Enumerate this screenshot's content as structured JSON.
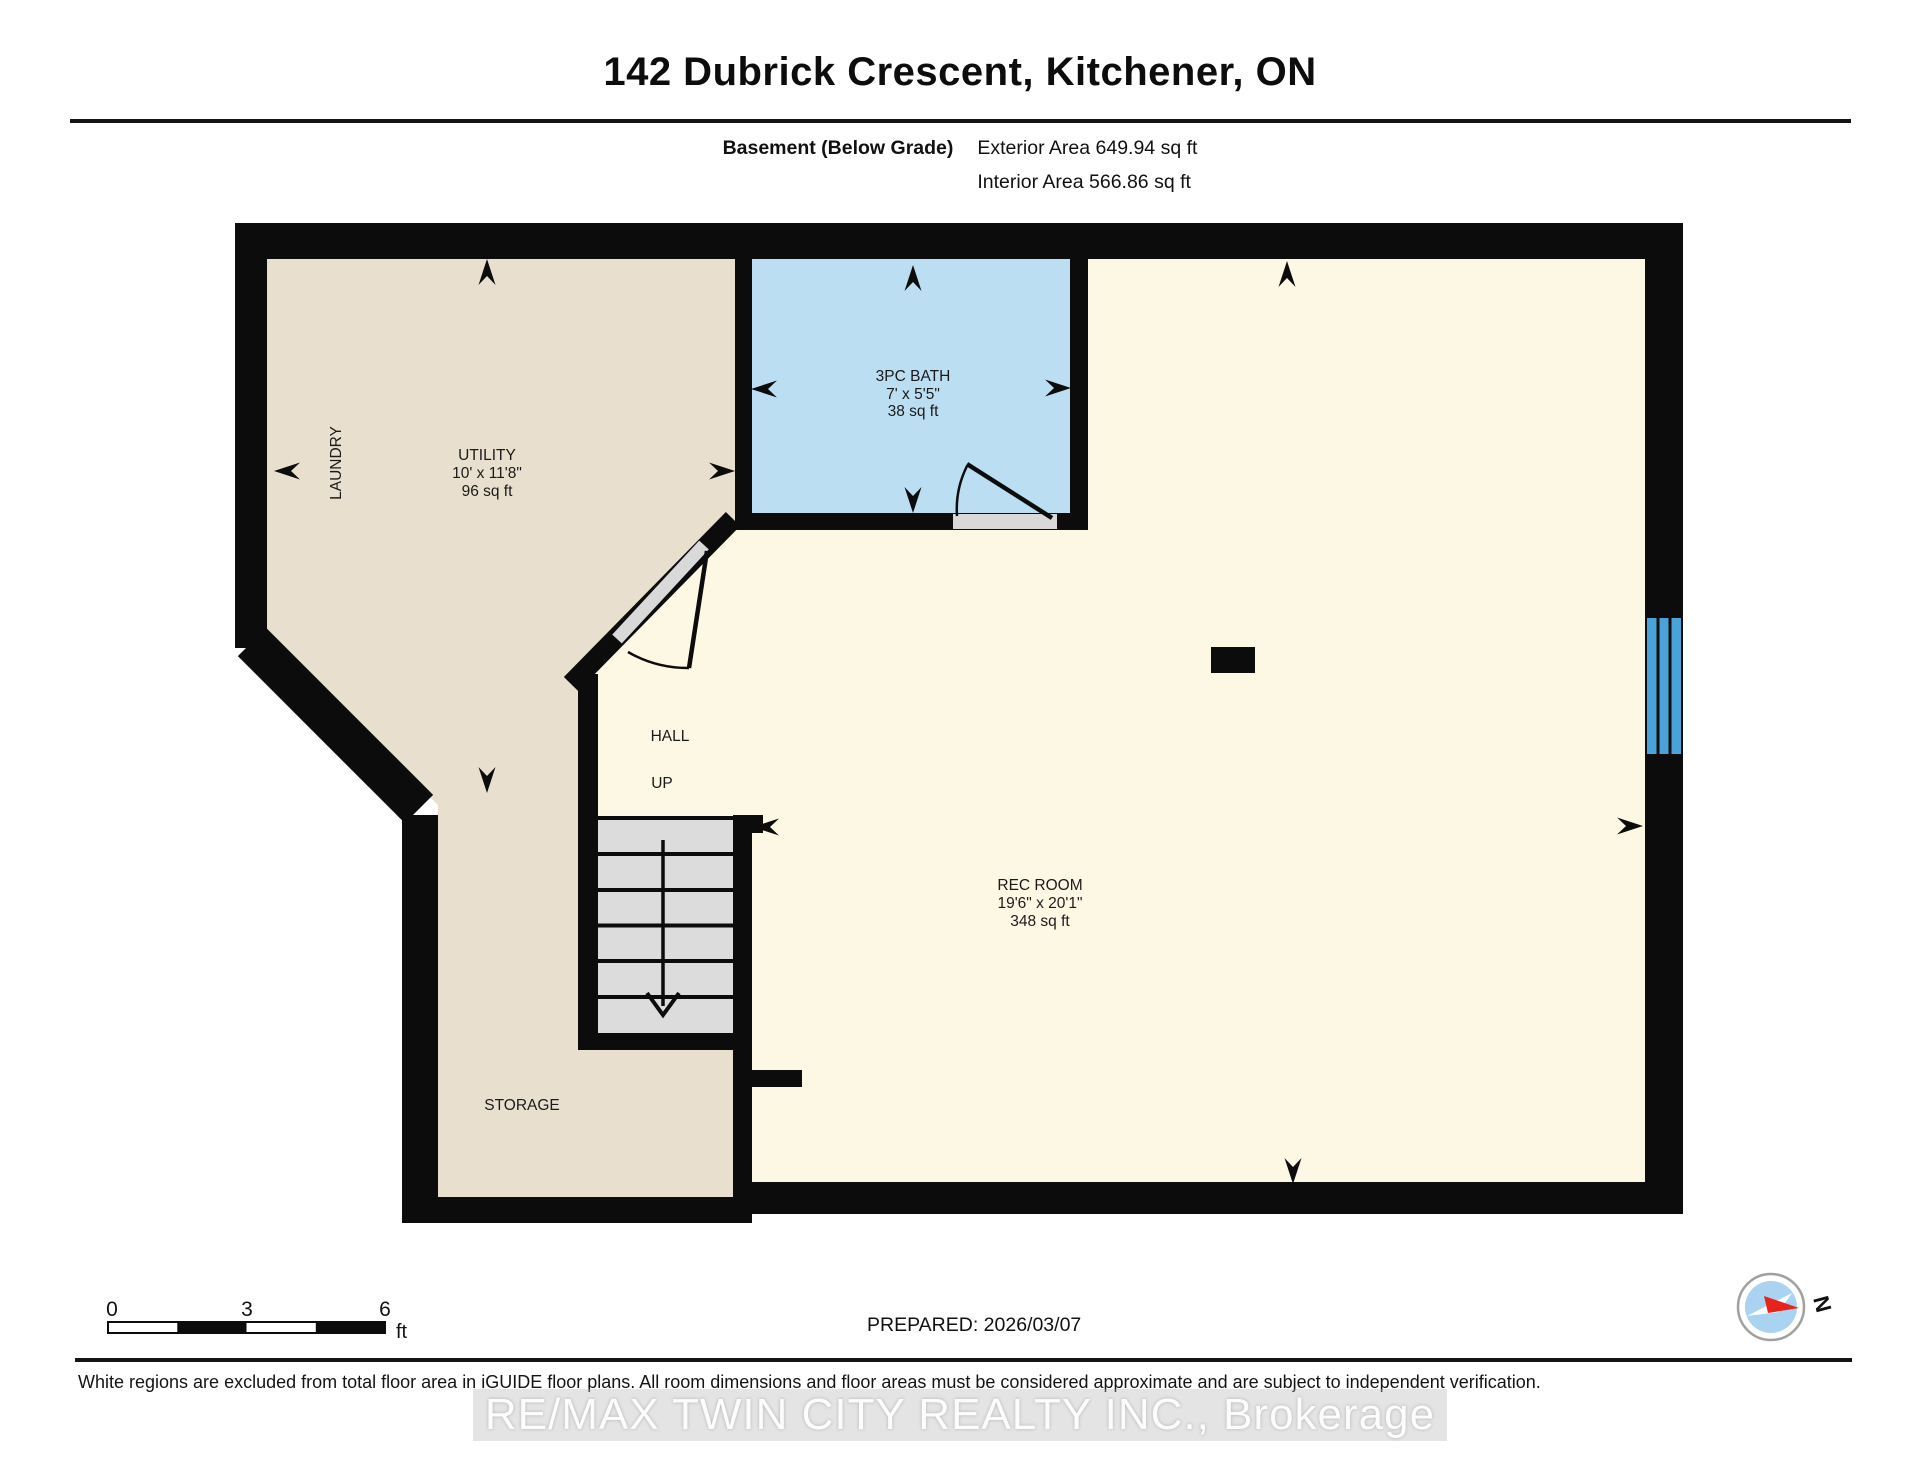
{
  "header": {
    "title": "142 Dubrick Crescent, Kitchener, ON",
    "floor_label": "Basement (Below Grade)",
    "exterior_area": "Exterior Area 649.94 sq ft",
    "interior_area": "Interior Area 566.86 sq ft"
  },
  "rooms": {
    "utility": {
      "name": "UTILITY",
      "dims": "10' x 11'8\"",
      "area": "96 sq ft"
    },
    "laundry": {
      "name": "LAUNDRY"
    },
    "bath": {
      "name": "3PC BATH",
      "dims": "7' x 5'5\"",
      "area": "38 sq ft"
    },
    "hall": {
      "name": "HALL"
    },
    "stairs": {
      "name": "UP"
    },
    "rec": {
      "name": "REC ROOM",
      "dims": "19'6\" x 20'1\"",
      "area": "348 sq ft"
    },
    "storage": {
      "name": "STORAGE"
    }
  },
  "scale_bar": {
    "zero": "0",
    "three": "3",
    "six": "6",
    "unit": "ft"
  },
  "footer": {
    "prepared": "PREPARED: 2026/03/07",
    "compass_label": "N",
    "disclaimer": "White regions are excluded from total floor area in iGUIDE floor plans. All room dimensions and floor areas must be considered approximate and are subject to independent verification.",
    "watermark": "RE/MAX TWIN CITY REALTY INC., Brokerage"
  },
  "colors": {
    "wall": "#0c0c0c",
    "utility_fill": "#e8dfce",
    "rec_fill": "#fdf8e4",
    "bath_fill": "#bcdef2",
    "window_blue": "#4aa3d8",
    "stair_gray": "#dcdcdc",
    "door_gray": "#d9d9d9",
    "compass_red": "#e8231c",
    "compass_blue": "#a9d3f0"
  }
}
